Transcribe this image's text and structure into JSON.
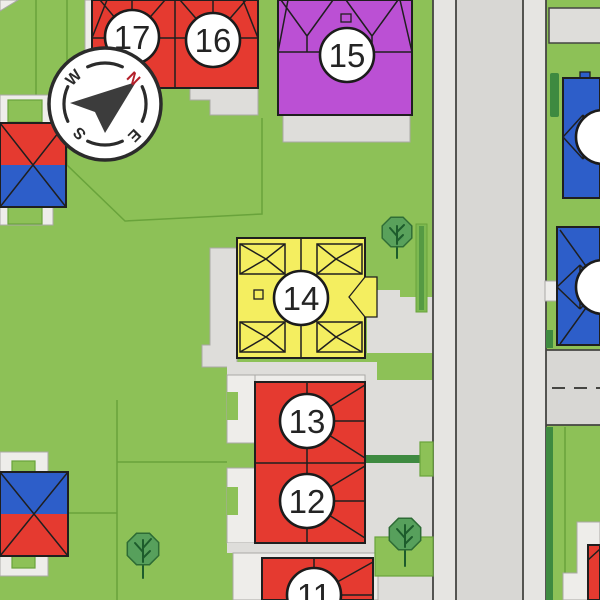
{
  "lots": [
    {
      "number": "11",
      "roof_color": "#e53a30"
    },
    {
      "number": "12",
      "roof_color": "#e53a30"
    },
    {
      "number": "13",
      "roof_color": "#e53a30"
    },
    {
      "number": "14",
      "roof_color": "#f4ee60"
    },
    {
      "number": "15",
      "roof_color": "#bb50d4"
    },
    {
      "number": "16",
      "roof_color": "#e53a30"
    },
    {
      "number": "17",
      "roof_color": "#e53a30"
    }
  ],
  "neighbor_buildings": {
    "left_upper": {
      "top_color": "#e53a30",
      "bottom_color": "#2d5ec9"
    },
    "left_lower": {
      "top_color": "#2d5ec9",
      "bottom_color": "#e53a30"
    },
    "right_upper": {
      "color": "#2d5ec9"
    },
    "right_lower": {
      "color": "#2d5ec9"
    },
    "bottom_right": {
      "color": "#e53a30"
    }
  },
  "compass": {
    "north": "N",
    "east": "E",
    "south": "S",
    "west": "W"
  },
  "colors": {
    "grass": "#8dc157",
    "plot_line": "#69a33b",
    "road": "#d8d7d4",
    "sidewalk": "#e6e5e2",
    "driveway": "#deddda",
    "pad": "#eeedea",
    "outline": "#1f1f1f",
    "red_roof": "#e53a30",
    "yellow_roof": "#f4ee60",
    "purple_roof": "#bb50d4",
    "blue_roof": "#2d5ec9",
    "tree": "#57a05c",
    "hedge_dark": "#3e8a40",
    "hedge_light": "#7db951",
    "compass_north": "#b3202a",
    "needle": "#3c3c3c"
  }
}
